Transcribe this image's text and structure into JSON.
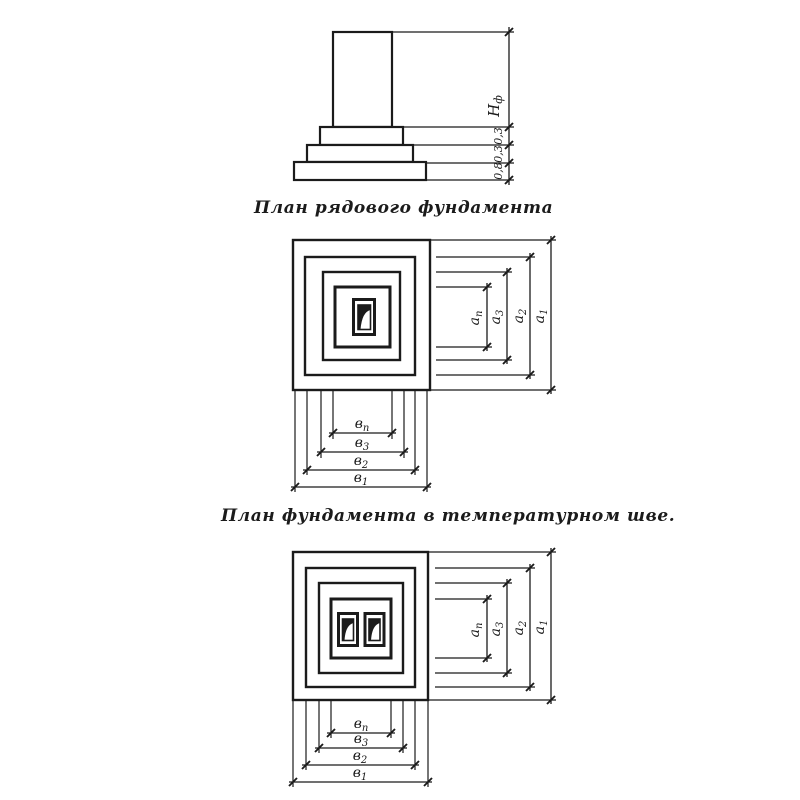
{
  "colors": {
    "ink": "#1b1b1b",
    "paper": "#ffffff"
  },
  "elevation": {
    "height_label": {
      "base": "Н",
      "sub": "ф"
    },
    "step_labels": [
      "0,3",
      "0,3",
      "0,8"
    ]
  },
  "captions": {
    "ordinary": "План рядового фундамента",
    "joint": "План фундамента в температурном шве."
  },
  "plan_ordinary": {
    "vertical_dims": [
      {
        "base": "а",
        "sub": "п"
      },
      {
        "base": "а",
        "sub": "3"
      },
      {
        "base": "а",
        "sub": "2"
      },
      {
        "base": "а",
        "sub": "1"
      }
    ],
    "horizontal_dims": [
      {
        "base": "в",
        "sub": "п"
      },
      {
        "base": "в",
        "sub": "3"
      },
      {
        "base": "в",
        "sub": "2"
      },
      {
        "base": "в",
        "sub": "1"
      }
    ]
  },
  "plan_joint": {
    "vertical_dims": [
      {
        "base": "а",
        "sub": "п"
      },
      {
        "base": "а",
        "sub": "3"
      },
      {
        "base": "а",
        "sub": "2"
      },
      {
        "base": "а",
        "sub": "1"
      }
    ],
    "horizontal_dims": [
      {
        "base": "в",
        "sub": "п"
      },
      {
        "base": "в",
        "sub": "3"
      },
      {
        "base": "в",
        "sub": "2"
      },
      {
        "base": "в",
        "sub": "1"
      }
    ]
  }
}
